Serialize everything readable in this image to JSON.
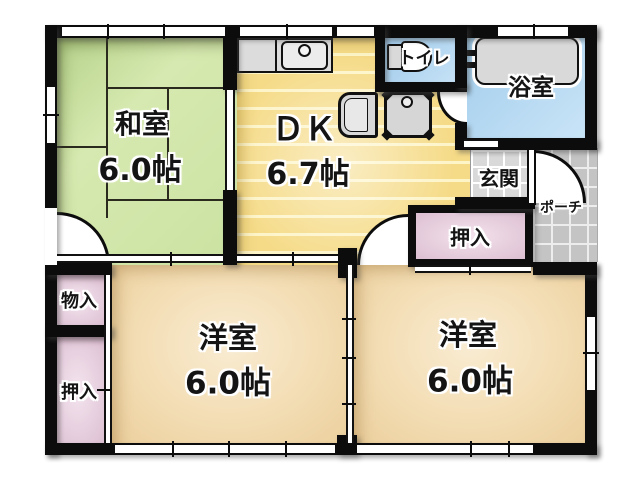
{
  "rooms": {
    "washitsu": {
      "label": "和室",
      "size": "6.0帖"
    },
    "dk": {
      "label": "ＤＫ",
      "size": "6.7帖"
    },
    "toilet": {
      "label": "トイレ"
    },
    "bathroom": {
      "label": "浴室"
    },
    "genkan": {
      "label": "玄関"
    },
    "porch": {
      "label": "ポーチ"
    },
    "yoshitsu_left": {
      "label": "洋室",
      "size": "6.0帖"
    },
    "yoshitsu_right": {
      "label": "洋室",
      "size": "6.0帖"
    },
    "oshiire_right": {
      "label": "押入"
    },
    "oshiire_left": {
      "label": "押入"
    },
    "monoire": {
      "label": "物入"
    }
  },
  "colors": {
    "wall_black": "#0c0c0c",
    "tatami_green": "#cde3a5",
    "dk_yellow": "#f5db88",
    "wood_tan": "#efd3a2",
    "closet_pink": "#e3c6d8",
    "water_blue": "#aed4f0",
    "genkan_tile_gray": "#d9d9d9",
    "porch_tile_gray": "#c4c4c4",
    "fixture_gray": "#d8d8d8"
  }
}
